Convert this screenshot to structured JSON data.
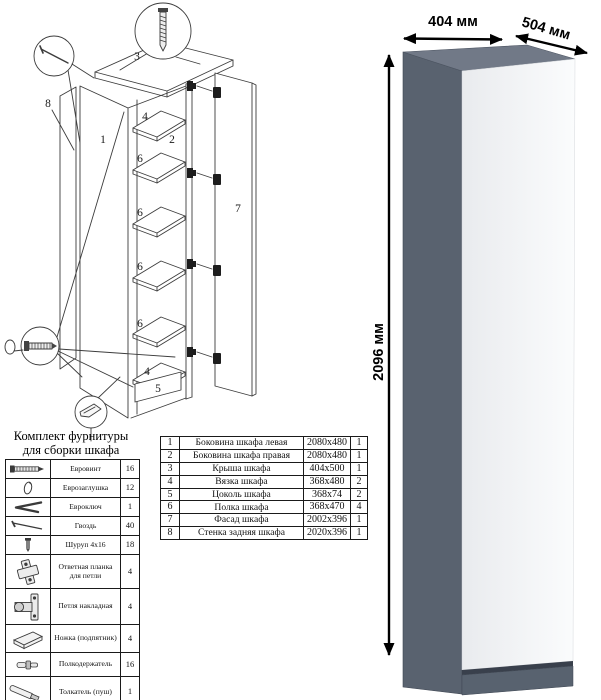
{
  "render": {
    "width_label": "404 мм",
    "depth_label": "504 мм",
    "height_label": "2096 мм",
    "colors": {
      "top": "#717987",
      "side": "#59626F",
      "door_dark": "#E9EBEE",
      "door_light": "#FBFCFD",
      "shadow": "#39404C",
      "plinth": "#58626F"
    }
  },
  "hardware": {
    "title_line1": "Комплект фурнитуры",
    "title_line2": "для сборки шкафа",
    "rows": [
      {
        "icon": "euro-screw-icon",
        "name": "Евровинт",
        "qty": "16"
      },
      {
        "icon": "euro-cap-icon",
        "name": "Еврозаглушка",
        "qty": "12"
      },
      {
        "icon": "euro-key-icon",
        "name": "Евроключ",
        "qty": "1"
      },
      {
        "icon": "nail-icon",
        "name": "Гвоздь",
        "qty": "40"
      },
      {
        "icon": "screw-icon",
        "name": "Шуруп 4x16",
        "qty": "18"
      },
      {
        "icon": "strike-plate-icon",
        "name": "Ответная планка для петли",
        "qty": "4"
      },
      {
        "icon": "hinge-icon",
        "name": "Петля накладная",
        "qty": "4"
      },
      {
        "icon": "foot-icon",
        "name": "Ножка (подпятник)",
        "qty": "4"
      },
      {
        "icon": "shelf-support-icon",
        "name": "Полкодержатель",
        "qty": "16"
      },
      {
        "icon": "pusher-icon",
        "name": "Толкатель (пуш)",
        "qty": "1"
      }
    ]
  },
  "parts": {
    "rows": [
      {
        "num": "1",
        "name": "Боковина шкафа левая",
        "size": "2080x480",
        "qty": "1"
      },
      {
        "num": "2",
        "name": "Боковина шкафа правая",
        "size": "2080x480",
        "qty": "1"
      },
      {
        "num": "3",
        "name": "Крыша шкафа",
        "size": "404x500",
        "qty": "1"
      },
      {
        "num": "4",
        "name": "Вязка шкафа",
        "size": "368x480",
        "qty": "2"
      },
      {
        "num": "5",
        "name": "Цоколь шкафа",
        "size": "368x74",
        "qty": "2"
      },
      {
        "num": "6",
        "name": "Полка шкафа",
        "size": "368x470",
        "qty": "4"
      },
      {
        "num": "7",
        "name": "Фасад шкафа",
        "size": "2002x396",
        "qty": "1"
      },
      {
        "num": "8",
        "name": "Стенка задняя шкафа",
        "size": "2020x396",
        "qty": "1"
      }
    ]
  },
  "diagram": {
    "part1": "1",
    "part2": "2",
    "part3": "3",
    "part4": "4",
    "part5": "5",
    "part6": "6",
    "part7": "7",
    "part8": "8"
  }
}
